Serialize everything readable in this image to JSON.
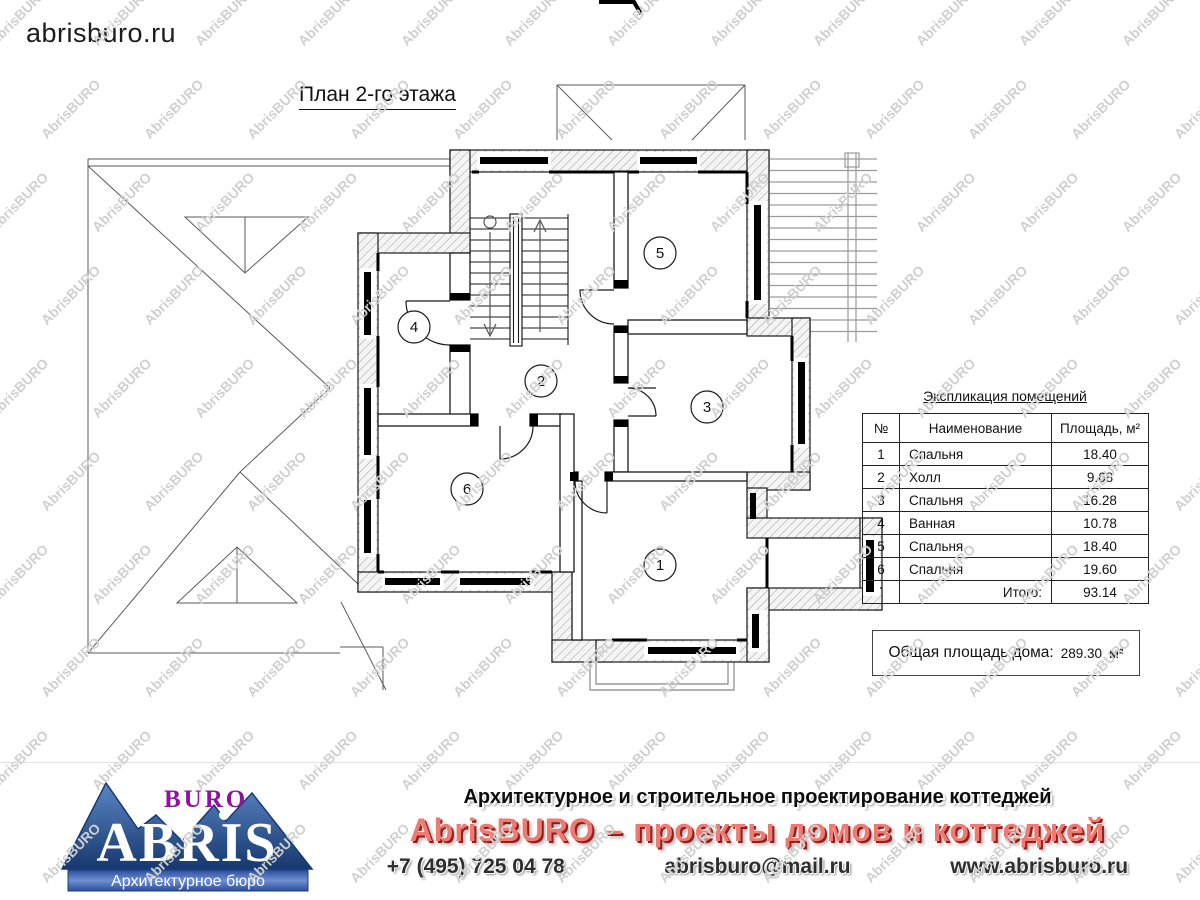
{
  "page": {
    "brand": "abrisburo.ru",
    "title": "План 2-го этажа"
  },
  "plan": {
    "room_numbers": [
      "1",
      "2",
      "3",
      "4",
      "5",
      "6"
    ]
  },
  "legend_table": {
    "title": "Экспликация помещений",
    "columns": [
      "№",
      "Наименование",
      "Площадь, м²"
    ],
    "rows": [
      {
        "num": "1",
        "name": "Спальня",
        "area": "18.40"
      },
      {
        "num": "2",
        "name": "Холл",
        "area": "9.68"
      },
      {
        "num": "3",
        "name": "Спальня",
        "area": "16.28"
      },
      {
        "num": "4",
        "name": "Ванная",
        "area": "10.78"
      },
      {
        "num": "5",
        "name": "Спальня",
        "area": "18.40"
      },
      {
        "num": "6",
        "name": "Спальня",
        "area": "19.60"
      }
    ],
    "total_label": "Итого:",
    "total_value": "93.14"
  },
  "total_area": {
    "label": "Общая площадь дома:",
    "value": "289.30",
    "unit": "м²"
  },
  "watermark": {
    "text": "AbrisBURO",
    "color": "#d0d0d0"
  },
  "footer": {
    "logo": {
      "buro": "BURO",
      "abris": "ABRIS",
      "tagline": "Архитектурное бюро",
      "blue": "#1c3f7d",
      "purple": "#90109f"
    },
    "line1": "Архитектурное и строительное проектирование коттеджей",
    "line2": "AbrisBURO – проекты домов и коттеджей",
    "phone": "+7 (495) 725 04 78",
    "email": "abrisburo@mail.ru",
    "website": "www.abrisburo.ru",
    "accent_red": "#ee7a72"
  }
}
